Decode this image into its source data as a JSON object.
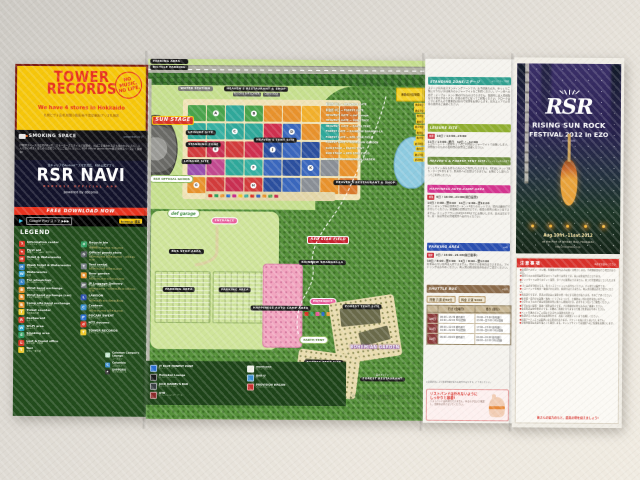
{
  "left_panel": {
    "tower": {
      "title1": "TOWER",
      "title2": "RECORDS",
      "slogan": "NO MUSIC, NO LIFE.",
      "sub": "We have 4 stores in Hokkaido",
      "stores": "札幌ピヴォ店/札幌狸小路店/新千歳空港店/アリオ札幌店"
    },
    "smoking": {
      "label": "SMOKING SPACE",
      "right": "presented by JT",
      "note": "JT喫煙スペースは会場内2ヶ所、スモーカーズスタイルで展開中。たばこを吸われる方も吸われない方も、みんなが心地よく楽しめる会場づくりにご協力ください。RSR official goods store横 JT喫煙スペースにて展開中!"
    },
    "app": {
      "lead": "全キャリアのAndroid™スマホ対応、RSR公式アプリ",
      "name": "RSR NAVI",
      "sub": "RSR2012 OFFICIAL APP",
      "powered": "powered by döcomo",
      "cta": "FREE DOWNLOAD NOW",
      "store": "Google Play ストア ▶▶▶",
      "tag": "tower.jp 検索"
    },
    "legend": {
      "title": "LEGEND",
      "col1": [
        {
          "c": "#d93425",
          "sym": "?",
          "en": "Information center",
          "jp": "インフォメーション"
        },
        {
          "c": "#d93425",
          "sym": "+",
          "en": "First aid",
          "jp": "救護テント・AED・お手伝い"
        },
        {
          "c": "#d93425",
          "sym": "H",
          "en": "Toilet & Waterworks",
          "jp": "トイレ・水道"
        },
        {
          "c": "#2f7fc4",
          "sym": "H",
          "en": "Wash toilet & Waterworks",
          "jp": "水洗トイレ・水道"
        },
        {
          "c": "#2f9fd4",
          "sym": "W",
          "en": "Waterworks",
          "jp": "水道"
        },
        {
          "c": "#2f7fc4",
          "sym": "♿",
          "en": "For wheelchair",
          "jp": "車イス対応トイレ・スロープ"
        },
        {
          "c": "#e8922c",
          "sym": "B",
          "en": "Wrist band exchange",
          "jp": "リストバンド交換所"
        },
        {
          "c": "#e8922c",
          "sym": "B",
          "en": "Wrist band exchange (car)",
          "jp": "クルマで来場の方 交換所"
        },
        {
          "c": "#e8922c",
          "sym": "B",
          "en": "Camp site band exchange",
          "jp": "キャンプサイトの方 交換所"
        },
        {
          "c": "#f0c929",
          "sym": "T",
          "en": "Ticket counter",
          "jp": "当日券売り場"
        },
        {
          "c": "#d93425",
          "sym": "R",
          "en": "Restaurant",
          "jp": "レストラン"
        },
        {
          "c": "#29a8c9",
          "sym": "W",
          "en": "Wi-Fi area",
          "jp": "Wi-Fiエリア"
        },
        {
          "c": "#2f9f5f",
          "sym": "S",
          "en": "Smoking area",
          "jp": "喫煙所"
        },
        {
          "c": "#d93425",
          "sym": "L",
          "en": "Lost & found office",
          "jp": "落とし物・忘れ物"
        },
        {
          "c": "#f0c929",
          "sym": "T",
          "en": "Taxi",
          "jp": "タクシー乗り場"
        }
      ],
      "col2": [
        {
          "c": "#2f9f5f",
          "sym": "♻",
          "en": "Recycle bin",
          "jp": "ゴミステーション",
          "t": "(分別回収) 9:00-22:00 / 6:00-22:00"
        },
        {
          "c": "#555a5f",
          "sym": "G",
          "en": "Official goods store",
          "jp": "オフィシャルグッズストア",
          "t": "10日/9:00-23:00 11日/8:00-23:00 ・12日/6:00-11:00"
        },
        {
          "c": "#7a8089",
          "sym": "T",
          "en": "Tent rental",
          "jp": "レンタルテント受付",
          "t": "10日/9:00-22:00 11日/8:00-22:00"
        },
        {
          "c": "#e8922c",
          "sym": "B",
          "en": "Beer garden",
          "jp": "ビアガーデン",
          "t": "10日/12:00-23:00 11日/11:00-23:00"
        },
        {
          "c": "#6a6f74",
          "sym": "JP",
          "en": "JP Luggage Delivery",
          "jp": "手荷物・宅配便預かり所",
          "t": "10日/9:00-23:00 ・11日/8:00-翌1:00 12日/6:00-11:00"
        },
        {
          "c": "#2a4fb0",
          "sym": "L",
          "en": "LAWSON",
          "jp": "ローソン",
          "t": "10日/9:00-翌2:00 11日/8:00-翌2:00"
        },
        {
          "c": "#3a8fd0",
          "sym": "C",
          "en": "Canteen",
          "jp": "カンティーン",
          "t": "10日/10:00-23:00 11日/9:00-23:00"
        },
        {
          "c": "#2a6fd0",
          "sym": "P",
          "en": "POCARI SWEAT",
          "jp": "ポカリスエット",
          "t": ""
        },
        {
          "c": "#d93425",
          "sym": "d",
          "en": "NTT docomo",
          "jp": "ドコモブース",
          "t": ""
        },
        {
          "c": "#f0c929",
          "sym": "T",
          "en": "TOWER RECORDS",
          "jp": "タワーレコードブース",
          "t": ""
        }
      ],
      "col3": [
        {
          "c": "#bfe3c9",
          "sym": "C",
          "en": "Coleman Camper's Lounge",
          "jp": "コールマン"
        },
        {
          "c": "#3a8fd0",
          "sym": "C",
          "en": "Columbia",
          "jp": "コロンビア"
        },
        {
          "c": "#2a2a2a",
          "sym": "★",
          "en": "SAPPORO",
          "jp": "サッポロビール"
        }
      ]
    }
  },
  "map": {
    "labels": {
      "parking_top": "PARKING AREA",
      "bicycle": "BICYCLE PARKING",
      "water_station": "WATER STATION",
      "heavens_rest_top": "HEAVEN'S RESTAURANT & SHOP",
      "subtag1": "FOODS & BAR CORNER",
      "subtag2": "CORN KIOSK",
      "sun_stage": "SUN STAGE",
      "leisure1": "LEISURE SITE",
      "standing": "STANDING ZONE",
      "leisure2": "LEISURE SITE",
      "heavens_tent": "HEAVEN'S TENT SITE",
      "goods": "RSR OFFICIAL GOODS",
      "heavens_rest_right": "HEAVEN'S RESTAURANT & SHOP",
      "def_garage": "def garage",
      "entrance1": "ENTRANCE",
      "bus_stop": "BUS STOP AREA",
      "parking_a": "PARKING AREA",
      "parking_b": "PARKING AREA",
      "happiness": "HAPPINESS AUTO-CAMP AREA",
      "red_star": "RED STAR FIELD",
      "rainbow": "RAINBOW SHANGRI-LA",
      "entrance2": "ENTRANCE",
      "earth_tent": "EARTH TENT",
      "forest_tent1": "FOREST TENT SITE",
      "forest_tent2": "FOREST TENT SITE",
      "bohemian": "BOHEMIAN GARDEN",
      "forest_kitchen": "森のキッチン",
      "forest_rest": "FOREST RESTAURANT"
    },
    "distances": {
      "header": "移動の目安時間",
      "rows": [
        {
          "route": "料金所 中口 → HEAVEN'S GATE",
          "t": "約10分"
        },
        {
          "route": "料金所 中口 → FOREST GATE",
          "t": "約15分"
        },
        {
          "route": "HEAVEN'S GATE → def garage",
          "t": "約5分"
        },
        {
          "route": "HEAVEN'S GATE → SUN STAGE",
          "t": "約8分"
        },
        {
          "route": "HEAVEN'S GATE → EARTH TENT",
          "t": "約10分"
        },
        {
          "route": "FOREST GATE → RAINBOW SHANGRI-LA",
          "t": "約5分"
        },
        {
          "route": "FOREST GATE → RED STAR FIELD",
          "t": "約8分"
        },
        {
          "route": "FOREST GATE → BOHEMIAN GARDEN",
          "t": "約10分"
        },
        {
          "route": "SUN STAGE → EARTH TENT",
          "t": "約5分"
        },
        {
          "route": "SUN STAGE → RED STAR FIELD",
          "t": "約15分"
        },
        {
          "route": "SUN STAGE → BOHEMIAN GARDEN",
          "t": "約20分"
        }
      ]
    },
    "blocks": [
      {
        "c": "#49a34b",
        "l": ""
      },
      {
        "c": "#49a34b",
        "l": "A"
      },
      {
        "c": "#2fa89a",
        "l": ""
      },
      {
        "c": "#49a34b",
        "l": "B"
      },
      {
        "c": "#e8922c",
        "l": ""
      },
      {
        "c": "#e8922c",
        "l": ""
      },
      {
        "c": "#f2b02c",
        "l": ""
      },
      {
        "c": "#e8922c",
        "l": ""
      },
      {
        "c": "#d9782c",
        "l": ""
      },
      {
        "c": "#2fa89a",
        "l": ""
      },
      {
        "c": "#35b0a2",
        "l": ""
      },
      {
        "c": "#2fa89a",
        "l": "C"
      },
      {
        "c": "#2fa89a",
        "l": ""
      },
      {
        "c": "#cf2f4e",
        "l": ""
      },
      {
        "c": "#3a67bd",
        "l": "D"
      },
      {
        "c": "#e8922c",
        "l": ""
      },
      {
        "c": "#2fa89a",
        "l": ""
      },
      {
        "c": "#e8922c",
        "l": ""
      },
      {
        "c": "#d23b3b",
        "l": ""
      },
      {
        "c": "#c92f52",
        "l": "E"
      },
      {
        "c": "#d23b3b",
        "l": ""
      },
      {
        "c": "#cf2f4e",
        "l": ""
      },
      {
        "c": "#2b4f9e",
        "l": "J"
      },
      {
        "c": "#3a67bd",
        "l": ""
      },
      {
        "c": "#2b4f9e",
        "l": ""
      },
      {
        "c": "#e8922c",
        "l": ""
      },
      {
        "c": "#f2b02c",
        "l": ""
      },
      {
        "c": "#9a4fae",
        "l": ""
      },
      {
        "c": "#c2498f",
        "l": ""
      },
      {
        "c": "#2fa89a",
        "l": ""
      },
      {
        "c": "#35b0a2",
        "l": "F"
      },
      {
        "c": "#3a67bd",
        "l": ""
      },
      {
        "c": "#2b4f9e",
        "l": ""
      },
      {
        "c": "#3a67bd",
        "l": "K"
      },
      {
        "c": "#8a8f96",
        "l": ""
      },
      {
        "c": "#e8922c",
        "l": ""
      },
      {
        "c": "#e8922c",
        "l": "G"
      },
      {
        "c": "#d23b3b",
        "l": ""
      },
      {
        "c": "#c92f52",
        "l": ""
      },
      {
        "c": "#d23b3b",
        "l": "H"
      },
      {
        "c": "#2b4f9e",
        "l": ""
      },
      {
        "c": "#3a67bd",
        "l": ""
      },
      {
        "c": "#8a8f96",
        "l": ""
      },
      {
        "c": "#e8922c",
        "l": ""
      },
      {
        "c": "#d9782c",
        "l": ""
      }
    ],
    "shop_icons": [
      {
        "c": "#d93425"
      },
      {
        "c": "#2f9f5f"
      },
      {
        "c": "#e8922c"
      },
      {
        "c": "#2a6fd0"
      },
      {
        "c": "#c92f8f"
      },
      {
        "c": "#f0c929"
      },
      {
        "c": "#2fa89a"
      },
      {
        "c": "#d93425"
      },
      {
        "c": "#3a67bd"
      },
      {
        "c": "#e8922c"
      },
      {
        "c": "#49a34b"
      },
      {
        "c": "#c92f52"
      }
    ],
    "shop_icons2": [
      {
        "c": "#d93425"
      },
      {
        "c": "#2f9f5f"
      },
      {
        "c": "#e85a9a"
      },
      {
        "c": "#2a6fd0"
      },
      {
        "c": "#e8922c"
      }
    ],
    "bottom_legend": [
      {
        "c": "#2a6fd0",
        "en": "JT BLUE HONEST ZONE",
        "jp": "ジェイティーゾーン"
      },
      {
        "c": "#1a1a1a",
        "en": "Heineken Lounge",
        "jp": "ハイネケンラウンジ"
      },
      {
        "c": "#3a3f44",
        "en": "JACK DANIEL'S BAR",
        "jp": "ジャックダニエルバー"
      },
      {
        "c": "#8a2a2a",
        "en": "OTB",
        "jp": "オフィシャルツアーブース"
      },
      {
        "c": "#f0f0e8",
        "en": "morricone",
        "jp": "モリコーネカフェ"
      },
      {
        "c": "#3a8fd0",
        "en": "BAR-U",
        "jp": "バー・ユー"
      },
      {
        "c": "#c92f2f",
        "en": "PROVISION WAGON",
        "jp": "プロビジョンワゴン"
      }
    ],
    "credit": "この地図は国土地理院発行の数値地図をもとに作成しています。会場レイアウトは変更になる場合があります。"
  },
  "info_panel": {
    "sections": [
      {
        "title": "STANDING ZONE/ステージ",
        "right": "※エリアマップ参照",
        "body": "ステージ前方はスタンディングゾーンです。お子様連れの方、ゆっくりご覧になりたい方は後方のレジャーサイトをご利用ください。ゾーン内への椅子・テーブル・テント類の持ち込みはできません。混雑時には入場規制を行う場合があります。係員の指示に従ってご観覧ください。クロークはございませんので貴重品は各自で管理をお願いします。前方エリアでの日傘の使用はご遠慮ください。"
      },
      {
        "title": "LEISURE SITE",
        "right": "",
        "sched": [
          {
            "tag": "開設",
            "t": "10日 / 13:00~24:00"
          },
          {
            "tag": "",
            "t": "11日 / 13:00~終日　12日 / ~12:00"
          }
        ],
        "body": "レジャーシート・簡易チェアのご利用はレジャーサイトでお願いします。場所取りのための長時間の放置はご遠慮ください。"
      },
      {
        "title": "HEAVEN'S & FOREST TENT SITE",
        "right": "※テントサイト券が必要です",
        "body": "テントサイト券をお持ちの方のみご利用いただけます。1区画にテント1張り・タープ1張りまで。区画外への設営はできません。お隣どうし譲り合ってご利用ください。"
      },
      {
        "title": "HAPPINESS AUTO-CAMP AREA",
        "right": "",
        "sched": [
          {
            "tag": "開設",
            "t": "9日 / 16:00~21:00(前日設営)"
          },
          {
            "tag": "",
            "t": "10日 / 9:00~翌3:00　11日 / 9:00~翌12:00"
          }
        ],
        "body": "オートキャンプ券は車両1台・テント1張りのセットです。場内は最徐行で走行してください。発電機の使用は禁止です。夜間の車両の出入りはできません。チェックアウトは12日12:00までにお願いします。直火は禁止です。炭・灰は所定の回収場所へお持ちください。"
      },
      {
        "title": "PARKING AREA",
        "right": "※P券",
        "sched": [
          {
            "tag": "開場",
            "t": "9日 / 16:00~21:00(前日駐車)"
          },
          {
            "tag": "",
            "t": "10日 / 8:00~翌3:00　11日 / 8:00~翌12:00"
          }
        ],
        "body": "駐車券のない車両は入場できません。場内での車中泊はできません。アイドリングはおやめください。再入場の際は駐車券を必ずご提示ください。"
      }
    ],
    "shuttle": {
      "title": "SHUTTLE BUS",
      "right": "※有料",
      "fare_time": "所要 片道 約50分",
      "fare": "料金 片道 ¥600",
      "col_go": "行き (会場行)",
      "col_back": "帰り (駅行)",
      "rows": [
        {
          "day": "10日",
          "go": "08:00~15:30 随時運行\n16:00~22:00 30分間隔",
          "back": "20:00~23:00 随時運行\n23:00~翌3:00 30分間隔"
        },
        {
          "day": "11日",
          "go": "08:00~12:00 随時運行\n16:00~22:00 30分間隔",
          "back": "17:00~23:00 随時運行\n23:00~翌6:00 30分間隔"
        },
        {
          "day": "12日",
          "go": "06:00~09:00 随時運行",
          "back": "06:00~09:00 随時運行\n09:00~12:00 30分間隔"
        }
      ],
      "note": "※道路状況により所要時間が変わる場合があります。ご了承ください。"
    },
    "wristband": {
      "title": "リストバンドは外れないように\nしっかりと装着!",
      "body": "リストバンドは再発行できません。ゆるみがないか確認し、会期中は外さないでください。"
    }
  },
  "cover": {
    "logo": "RSR",
    "title1": "RISING SUN ROCK",
    "title2": "FESTIVAL 2012 in EZO",
    "since": "since1999",
    "date": "Aug.10fri.-11sat.2012",
    "place": "at the Port of Ishikari Bay, Hokkaido",
    "url": "http://rsr.wess.co.jp"
  },
  "notes": {
    "title": "注意事項",
    "subtitle": "※必ずお読みください",
    "lines": [
      "●会場内へのビン・カン類、危険物の持ち込みは固くお断りします。手荷物検査を行う場合があります。",
      "●場内での火の使用は所定のエリア以外では禁止です。直火は全面禁止となります。",
      "●テントサイト以外でのテント設営、タープの設置はできません。見つけ次第撤去していただきます。",
      "●ゴミは必ず分別のうえ、各ゴミステーションへお持ちください。ポイ捨ては厳禁です。",
      "●リストバンドを紛失・破損された場合、再発行はできません。再入場の際は必ずご提示ください。",
      "●雨天決行ですが、荒天の場合は公演を中断・中止する場合があります。予めご了承ください。",
      "●駐車場・場内での盗難・事故・トラブルについて、主催者は一切の責任を負いません。",
      "●小学生以下のお子様は保護者同伴に限り入場無料です。必ず手をつないでご観覧ください。",
      "●許可のない録音・録画・撮影は禁止です。プロ用機材の持ち込みはご遠慮ください。",
      "●会場周辺は駐停車禁止です。近隣のご迷惑となりますので路上駐車はおやめください。",
      "●ペットを連れてのご入場はできません(補助犬を除く)。",
      "●体調がすぐれない場合は無理をせず、お近くの救護テントまでお越しください。",
      "●出演アーティストは変更になる場合があります。チケットの払い戻しはいたしません。",
      "●深夜時間帯は音量を落として運営します。キャンプサイトでは周囲へのご配慮をお願いします。"
    ],
    "footer": "皆さんの協力のもと、最高の朝を迎えましょう!"
  }
}
